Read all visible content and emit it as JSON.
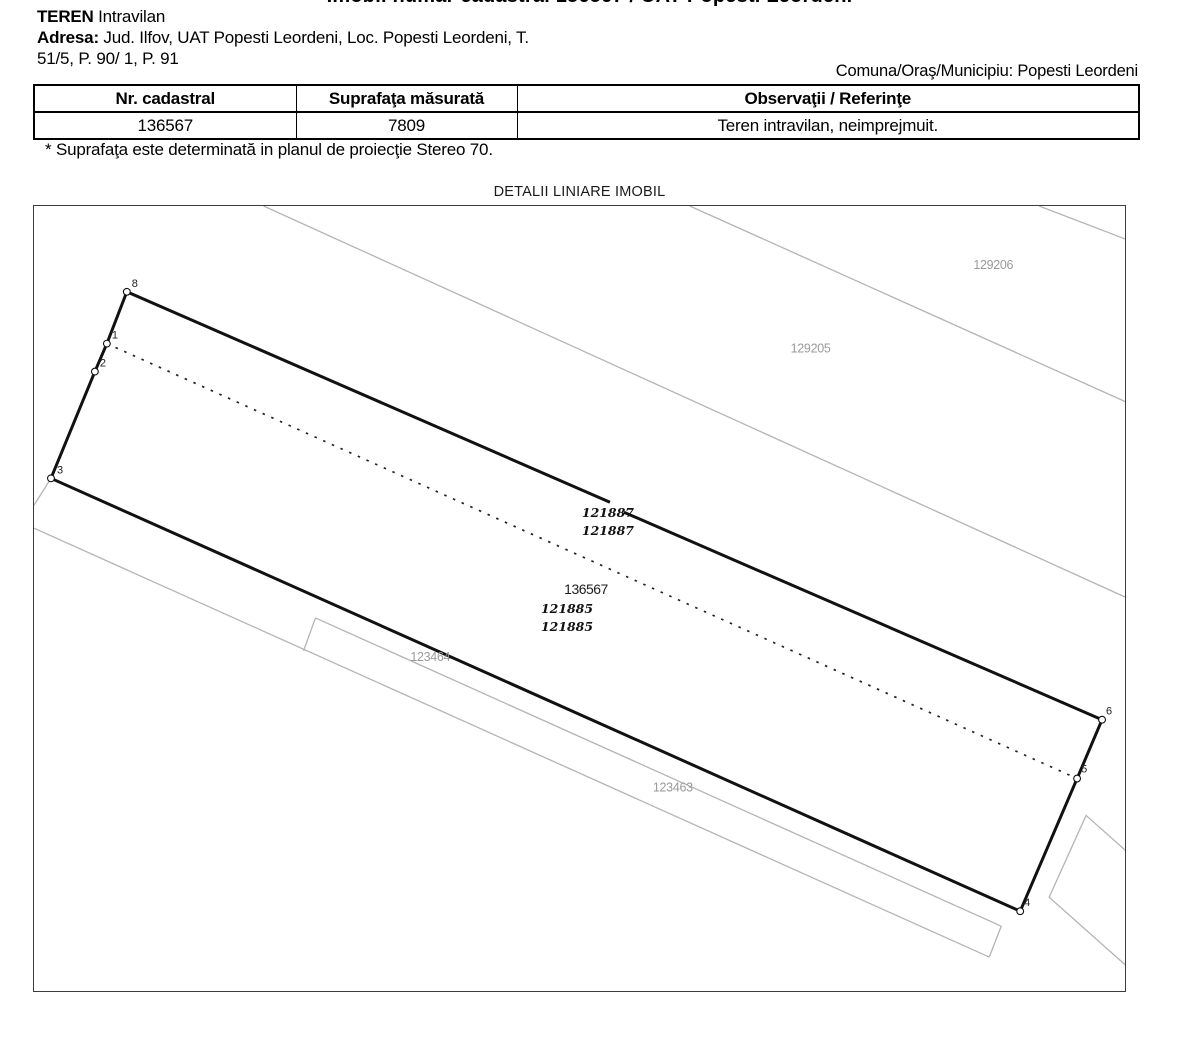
{
  "document": {
    "title_partial": "Imobil numar cadastral 136567 / UAT Popesti Leordeni",
    "teren_label": "TEREN",
    "teren_value": " Intravilan",
    "adresa_label": "Adresa:",
    "adresa_value": " Jud. Ilfov, UAT Popesti Leordeni, Loc. Popesti Leordeni, T.",
    "adresa_line2": "51/5, P. 90/ 1, P. 91",
    "comuna_line": "Comuna/Oraş/Municipiu: Popesti Leordeni",
    "footnote": "* Suprafaţa este determinată in planul de proiecţie Stereo 70.",
    "map_title": "DETALII LINIARE IMOBIL"
  },
  "table": {
    "headers": [
      "Nr. cadastral",
      "Suprafaţa măsurată",
      "Observaţii / Referinţe"
    ],
    "row": [
      "136567",
      "7809",
      "Teren intravilan, neimprejmuit."
    ]
  },
  "map": {
    "parcel_number": "136567",
    "colors": {
      "boundary": "#111111",
      "neighbor": "#b4b4b4",
      "frame": "#3c3c3c",
      "gray_label": "#9a9a9a"
    },
    "solid_edges": [
      [
        126,
        291,
        106,
        343
      ],
      [
        106,
        343,
        94,
        371
      ],
      [
        94,
        371,
        50,
        478
      ],
      [
        50,
        478,
        1021,
        912
      ],
      [
        1021,
        912,
        1078,
        779
      ],
      [
        1078,
        779,
        1103,
        720
      ],
      [
        1103,
        720,
        624,
        512
      ],
      [
        610,
        502,
        126,
        291
      ]
    ],
    "dashed_edges": [
      [
        106,
        343,
        1078,
        779
      ]
    ],
    "neighbor_lines": [
      [
        263,
        205,
        1126,
        597
      ],
      [
        690,
        205,
        1126,
        401
      ],
      [
        1040,
        205,
        1126,
        238
      ],
      [
        50,
        478,
        33,
        505
      ],
      [
        33,
        528,
        990,
        958
      ],
      [
        315,
        618,
        1002,
        927
      ],
      [
        315,
        618,
        303,
        651
      ],
      [
        1002,
        927,
        990,
        958
      ]
    ],
    "neighbor_polygons": [
      [
        [
          1087,
          816
        ],
        [
          1177,
          896
        ],
        [
          1140,
          978
        ],
        [
          1050,
          898
        ]
      ]
    ],
    "vertices": [
      {
        "n": "8",
        "cx": 126,
        "cy": 291,
        "lx": 131,
        "ly": 286
      },
      {
        "n": "1",
        "cx": 106,
        "cy": 343,
        "lx": 111,
        "ly": 338
      },
      {
        "n": "2",
        "cx": 94,
        "cy": 371,
        "lx": 99,
        "ly": 366
      },
      {
        "n": "3",
        "cx": 50,
        "cy": 478,
        "lx": 56,
        "ly": 473
      },
      {
        "n": "6",
        "cx": 1103,
        "cy": 720,
        "lx": 1107,
        "ly": 715
      },
      {
        "n": "5",
        "cx": 1078,
        "cy": 779,
        "lx": 1082,
        "ly": 773
      },
      {
        "n": "4",
        "cx": 1021,
        "cy": 912,
        "lx": 1025,
        "ly": 907
      }
    ],
    "labels": [
      {
        "text": "129206",
        "x": 994,
        "y": 268,
        "cls": "lbl-gray"
      },
      {
        "text": "129205",
        "x": 811,
        "y": 352,
        "cls": "lbl-gray"
      },
      {
        "text": "121887",
        "x": 608,
        "y": 517,
        "cls": "lbl-serif"
      },
      {
        "text": "121887",
        "x": 608,
        "y": 535,
        "cls": "lbl-serif"
      },
      {
        "text": "136567",
        "x": 586,
        "y": 594,
        "cls": "lbl-main"
      },
      {
        "text": "121885",
        "x": 567,
        "y": 613,
        "cls": "lbl-serif"
      },
      {
        "text": "121885",
        "x": 567,
        "y": 631,
        "cls": "lbl-serif"
      },
      {
        "text": "123464",
        "x": 430,
        "y": 661,
        "cls": "lbl-gray"
      },
      {
        "text": "123463",
        "x": 673,
        "y": 792,
        "cls": "lbl-gray"
      }
    ]
  }
}
